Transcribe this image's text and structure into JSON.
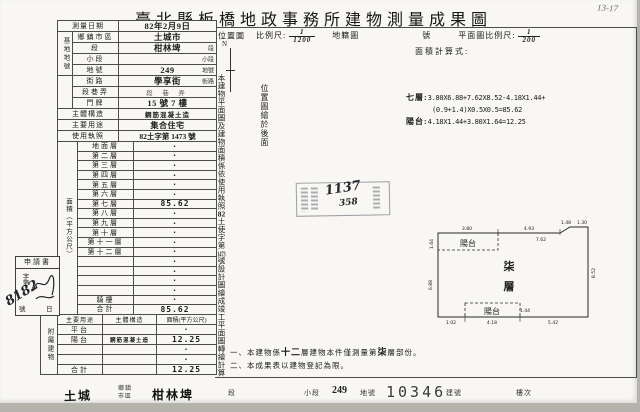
{
  "title": "臺北縣板橋地政事務所建物測量成果圖",
  "misc": {
    "corner": "13-17",
    "north": "N"
  },
  "scale_row": {
    "loc": "位置圖",
    "scale_label": "比例尺:",
    "s1n": "1",
    "s1d": "1200",
    "cad": "地籍圖",
    "no": "號",
    "plan_label": "平面圖比例尺:",
    "s2n": "1",
    "s2d": "200",
    "calc": "面積計算式:"
  },
  "left": {
    "date_label": "測量日期",
    "date_value": "82年2月9日",
    "group1": "基地地號",
    "rows": [
      {
        "label": "鄉鎮市區",
        "value": "土城市",
        "suffix": ""
      },
      {
        "label": "段",
        "value": "柑林埤",
        "suffix": "段"
      },
      {
        "label": "小段",
        "value": "",
        "suffix": "小段"
      },
      {
        "label": "地號",
        "value": "249",
        "suffix": "地號"
      },
      {
        "label": "街路",
        "value": "學享街",
        "suffix": "街路"
      },
      {
        "label": "段巷弄",
        "value": "段 巷 弄",
        "suffix": ""
      },
      {
        "label": "門牌",
        "value": "15 號 7 樓",
        "suffix": ""
      },
      {
        "label": "主體構造",
        "value": "鋼筋混凝土造",
        "suffix": ""
      },
      {
        "label": "主要用途",
        "value": "集合住宅",
        "suffix": ""
      },
      {
        "label": "使用執照",
        "value": "82土字第 1473 號",
        "suffix": ""
      }
    ],
    "floors_label": "面積（平方公尺）",
    "floors": [
      {
        "label": "地面層",
        "value": "·"
      },
      {
        "label": "第二層",
        "value": "·"
      },
      {
        "label": "第三層",
        "value": "·"
      },
      {
        "label": "第四層",
        "value": "·"
      },
      {
        "label": "第五層",
        "value": "·"
      },
      {
        "label": "第六層",
        "value": "·"
      },
      {
        "label": "第七層",
        "value": "85.62"
      },
      {
        "label": "第八層",
        "value": "·"
      },
      {
        "label": "第九層",
        "value": "·"
      },
      {
        "label": "第十層",
        "value": "·"
      },
      {
        "label": "第十一層",
        "value": "·"
      },
      {
        "label": "第十二層",
        "value": "·"
      },
      {
        "label": "",
        "value": "·"
      },
      {
        "label": "",
        "value": "·"
      },
      {
        "label": "",
        "value": "·"
      },
      {
        "label": "",
        "value": "·"
      },
      {
        "label": "騎樓",
        "value": "·"
      },
      {
        "label": "合計",
        "value": "85.62"
      }
    ],
    "attached": {
      "group": "附屬建物",
      "h1": "主要用途",
      "h2": "主體構造",
      "h3": "面積(平方公尺)",
      "rows": [
        {
          "use": "平台",
          "structure": "",
          "area": "·"
        },
        {
          "use": "陽台",
          "structure": "鋼筋混凝土造",
          "area": "12.25"
        },
        {
          "use": "",
          "structure": "",
          "area": "·"
        },
        {
          "use": "",
          "structure": "",
          "area": "·"
        },
        {
          "use": "合計",
          "structure": "",
          "area": "12.25"
        }
      ]
    }
  },
  "app_box": {
    "header": "申請書",
    "col": "字第",
    "no": "號",
    "day": "日",
    "number": "8182"
  },
  "vnote": {
    "p1": "本建物平面圖及建物面積係依使用執照",
    "p2": "82",
    "p3": "土使字第",
    "p4": "1473",
    "p5": "號設計圖繪成竣工平面圖轉繪計算"
  },
  "locnote": "位置圖繪於後面",
  "formulas": {
    "l1_label": "七層:",
    "l1": "3.80X6.88+7.62X8.52-4.18X1.44+",
    "l2": "(0.9+1.4)X0.5X0.5=85.62",
    "l3_label": "陽台:",
    "l3": "4.18X1.44+3.80X1.64=12.25"
  },
  "stamp": {
    "num1": "1137",
    "num2": "358"
  },
  "plan": {
    "floor_char1": "柒",
    "floor_char2": "層",
    "balcony_label": "陽台",
    "dims": {
      "top1": "3.80",
      "top2": "4.93",
      "notch1": "1.48",
      "notch2": "1.30",
      "inner_top": "7.62",
      "left1": "1.64",
      "left2": "6.88",
      "right": "8.52",
      "bottom1": "1.02",
      "bottom2": "4.18",
      "bottom3": "5.42",
      "balcony2_h": "1.44"
    }
  },
  "notes": {
    "n1a": "一、本建物係",
    "n1b": "十二",
    "n1c": "層建物本件僅測量第",
    "n1d": "柒",
    "n1e": "層部份。",
    "n2": "二、本成果表以建物登記為限。"
  },
  "strip": {
    "town": "土城",
    "town_label1": "鄉鎮",
    "town_label2": "市區",
    "section": "柑林埤",
    "section_label": "段",
    "subsection_label": "小段",
    "lot": "249",
    "lot_label": "地號",
    "building_no": "10346",
    "building_label": "建號",
    "floor_label": "樓次"
  },
  "colors": {
    "ink": "#1d1d1d",
    "paper": "#f8f7f3",
    "stamp_ink": "#46465a"
  }
}
